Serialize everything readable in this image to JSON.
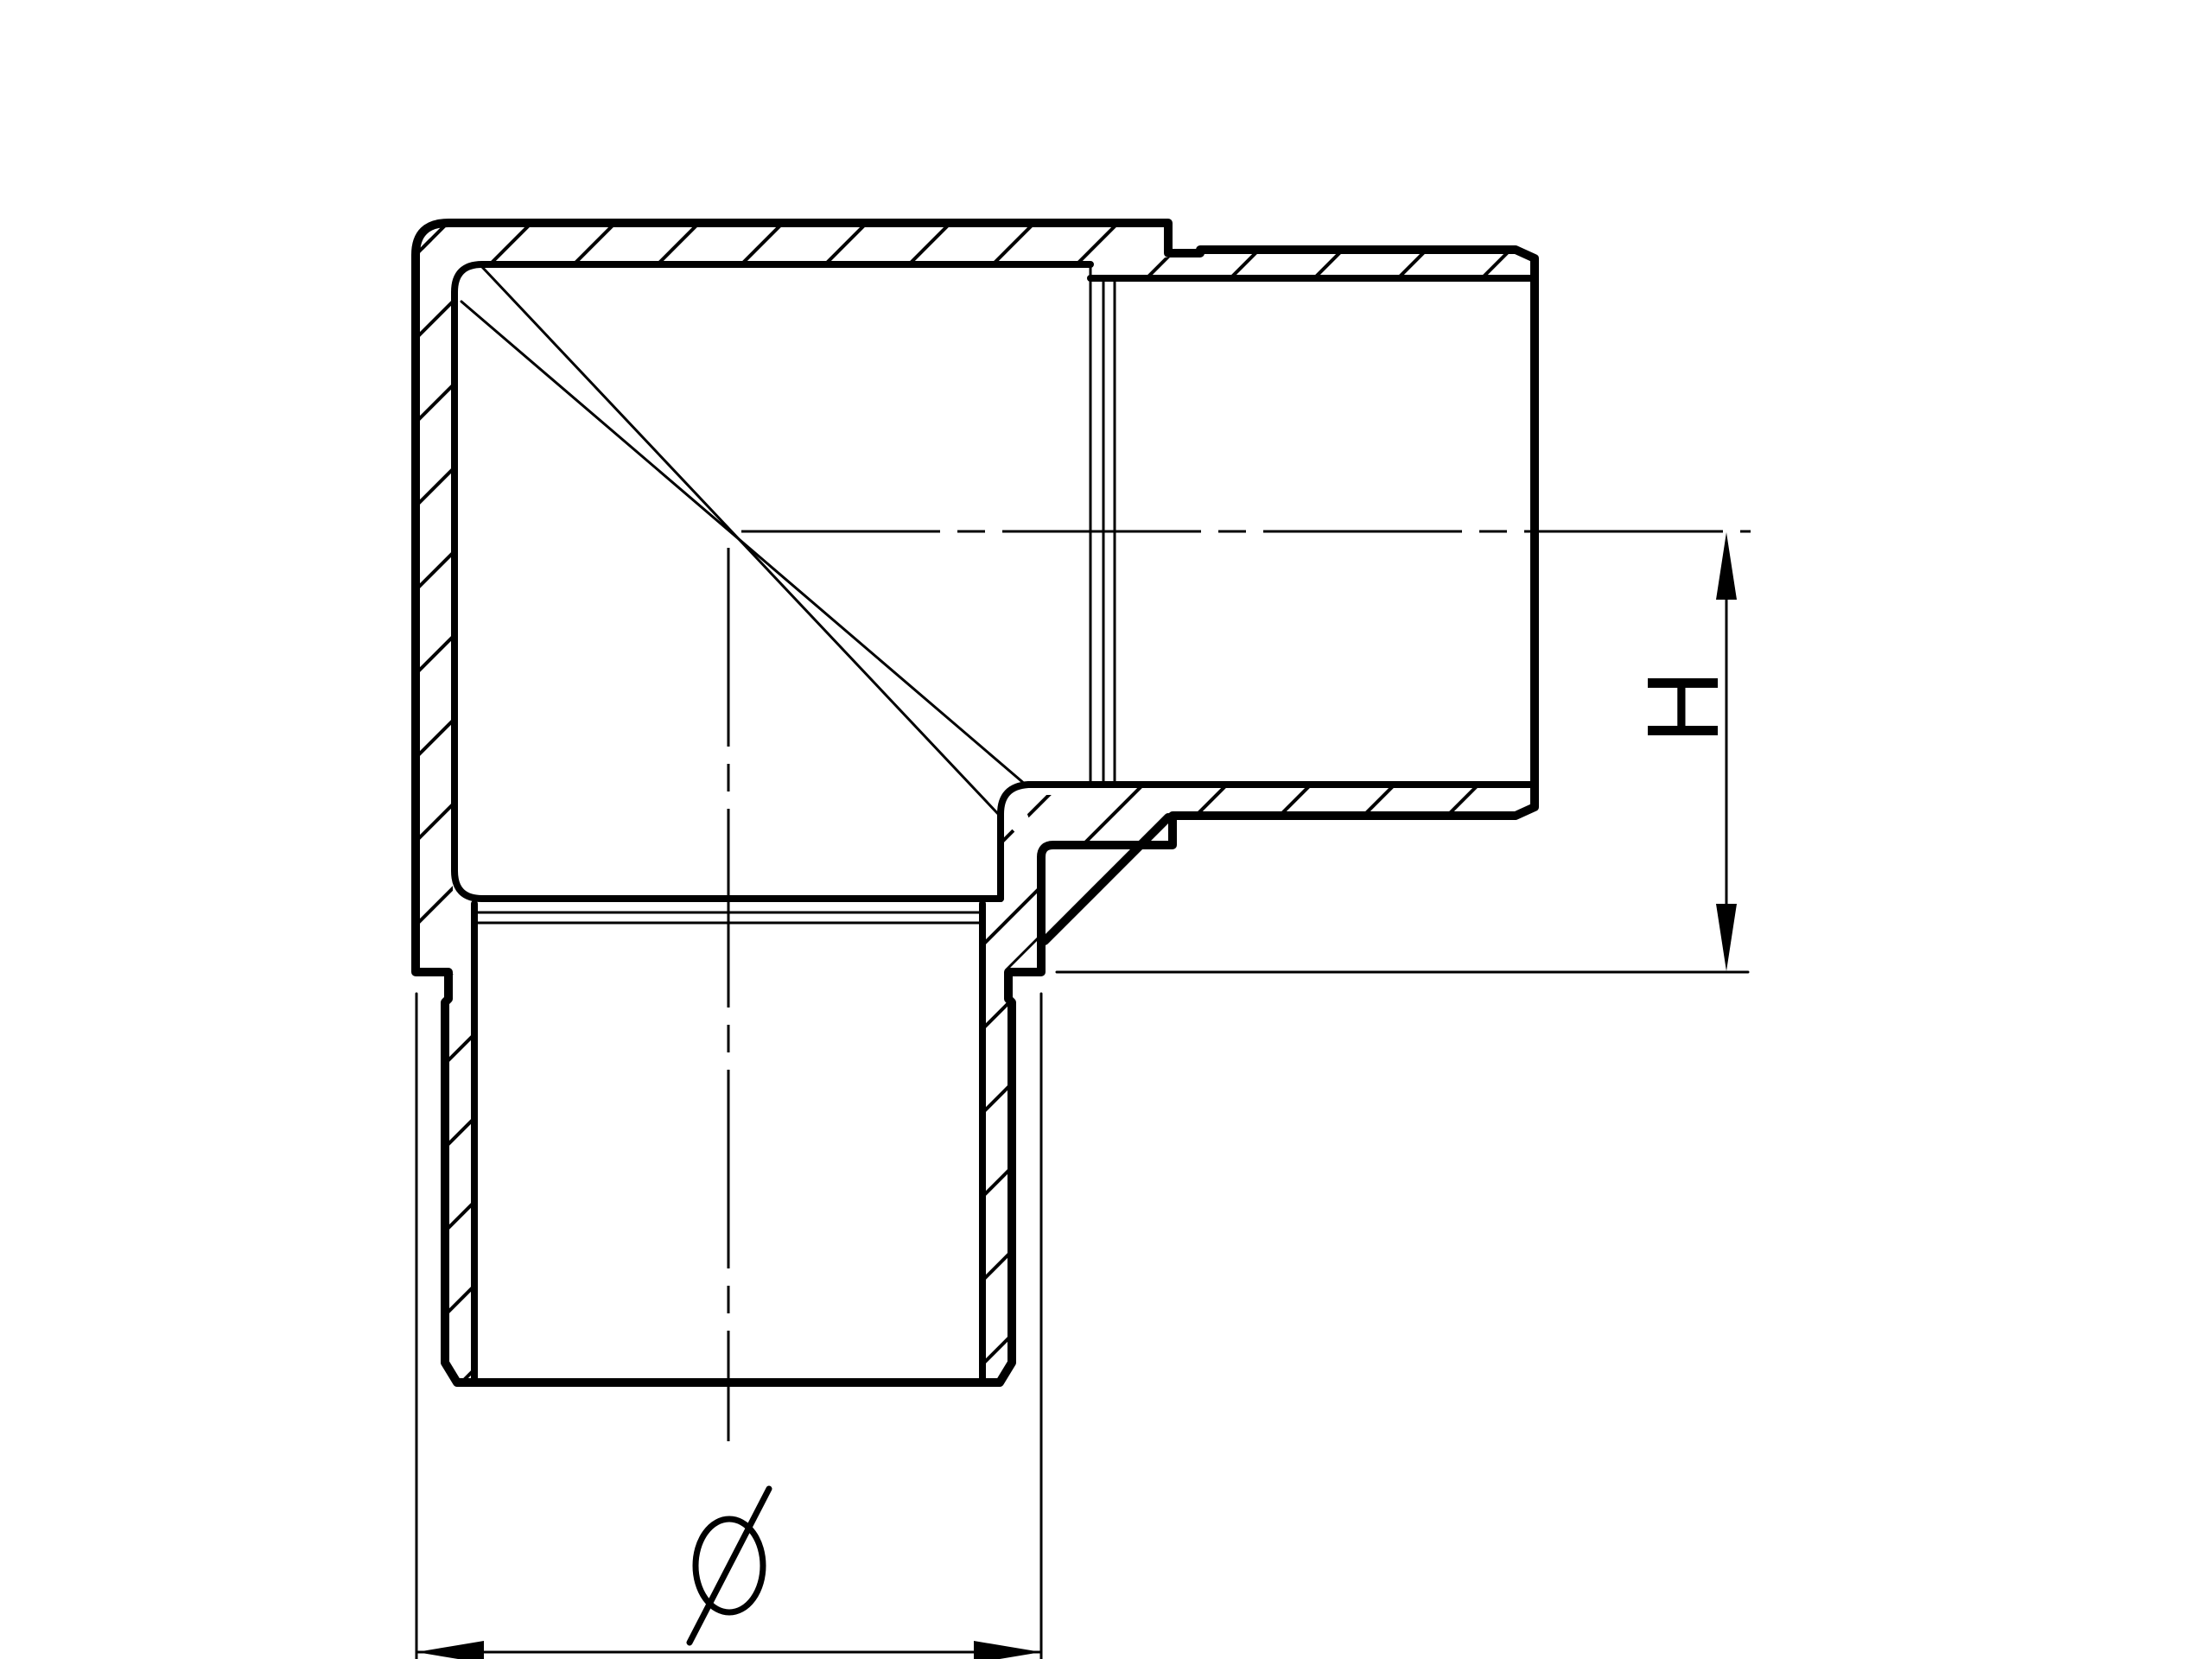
{
  "drawing": {
    "title": "90-degree elbow tube fitting - sectional view",
    "background_color": "#ffffff",
    "line_color": "#000000",
    "view": "full-section",
    "hatch_angle_deg": 45,
    "dimension_labels": {
      "height": "H",
      "diameter": "Ø"
    },
    "features": [
      "rounded outer corner top-left",
      "horizontal spigot with end chamfer",
      "vertical spigot with end chamfer",
      "relief grooves at spigot bases",
      "internal bore shoulders with chamfer edges",
      "miter seam lines crossing at bore axes intersection",
      "dash-dot centerlines on both bore axes"
    ]
  }
}
